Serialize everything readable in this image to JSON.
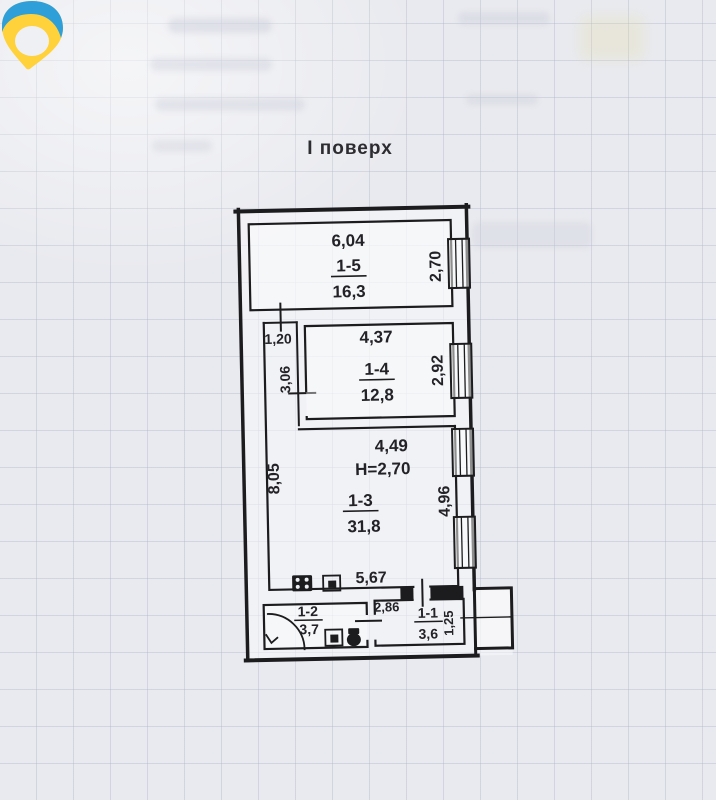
{
  "header": {
    "floor_title": "І поверх"
  },
  "logo": {
    "name": "brand-logo"
  },
  "rooms": {
    "r15": {
      "label": "1-5",
      "area": "16,3",
      "dim_top": "6,04",
      "dim_right": "2,70"
    },
    "r14": {
      "label": "1-4",
      "area": "12,8",
      "dim_top": "4,37",
      "dim_right": "2,92",
      "dim_left": "3,06"
    },
    "r13": {
      "label": "1-3",
      "area": "31,8",
      "dim_top": "4,49",
      "dim_height": "H=2,70",
      "dim_left": "8,05",
      "dim_right": "4,96",
      "dim_bottom": "5,67"
    },
    "r12": {
      "label": "1-2",
      "area": "3,7"
    },
    "r11": {
      "label": "1-1",
      "area": "3,6",
      "dim_top": "2,86",
      "dim_right": "1,25"
    },
    "hall": {
      "dim_width": "1,20"
    }
  },
  "icons": {
    "stove": "stove-icon",
    "sink": "sink-icon",
    "washbasin": "washbasin-icon",
    "toilet": "toilet-icon",
    "door_swing": "door-swing-arc",
    "window": "window-symbol",
    "logo": "brand-logo"
  },
  "colors": {
    "logo_blue": "#2f9fd9",
    "logo_yellow": "#ffd23c",
    "line": "#1c1c1f",
    "paper": "#e9eaef"
  }
}
